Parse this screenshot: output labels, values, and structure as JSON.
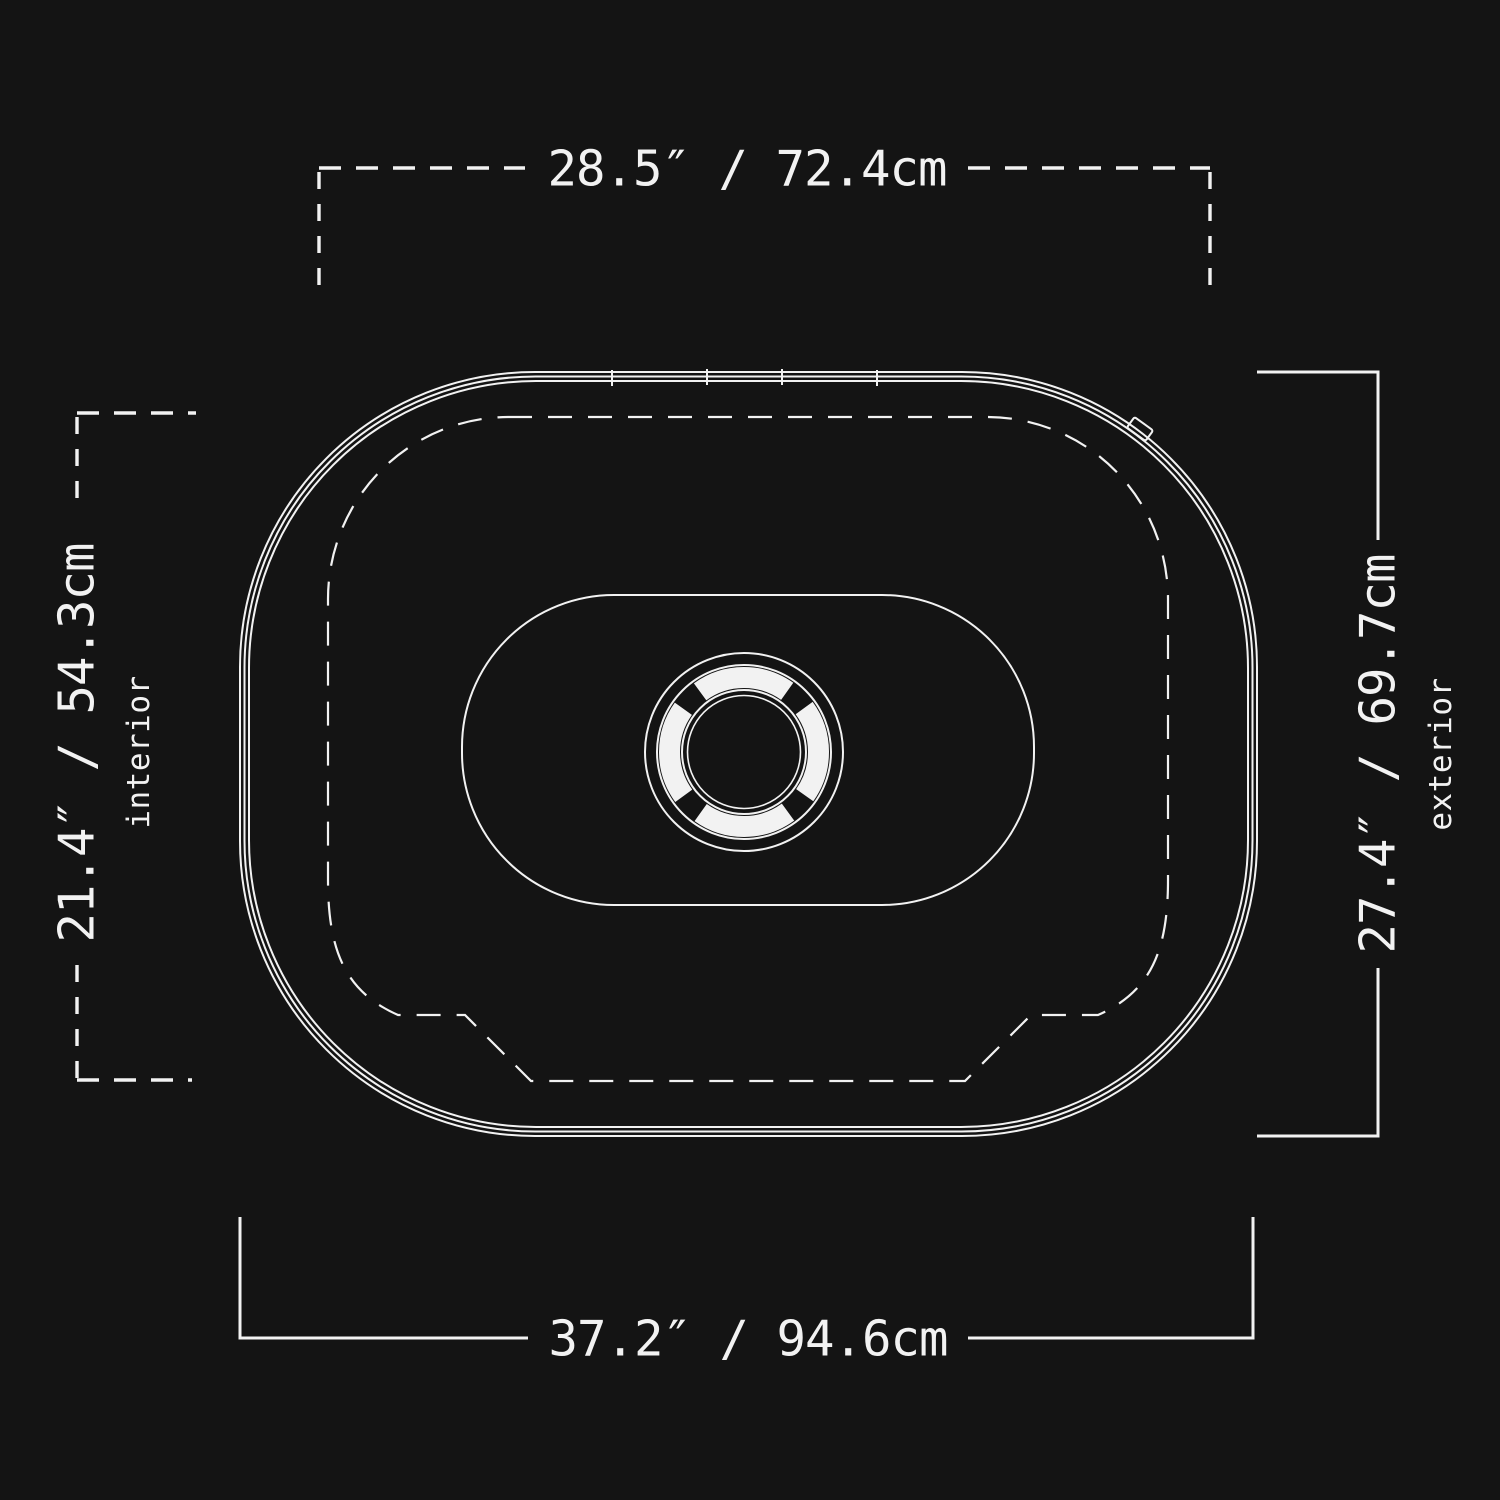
{
  "colors": {
    "bg": "#141414",
    "line": "#f2f2f2"
  },
  "diagram": {
    "kind": "product top-view dimension drawing",
    "dimensions": {
      "top_width": {
        "text": "28.5″ / 72.4cm",
        "line_style": "dashed",
        "refers_to": "interior width"
      },
      "bottom_width": {
        "text": "37.2″ / 94.6cm",
        "line_style": "solid",
        "refers_to": "exterior width"
      },
      "left_height": {
        "text": "21.4″ / 54.3cm",
        "label": "interior",
        "line_style": "dashed"
      },
      "right_height": {
        "text": "27.4″ / 69.7cm",
        "label": "exterior",
        "line_style": "solid"
      }
    }
  }
}
